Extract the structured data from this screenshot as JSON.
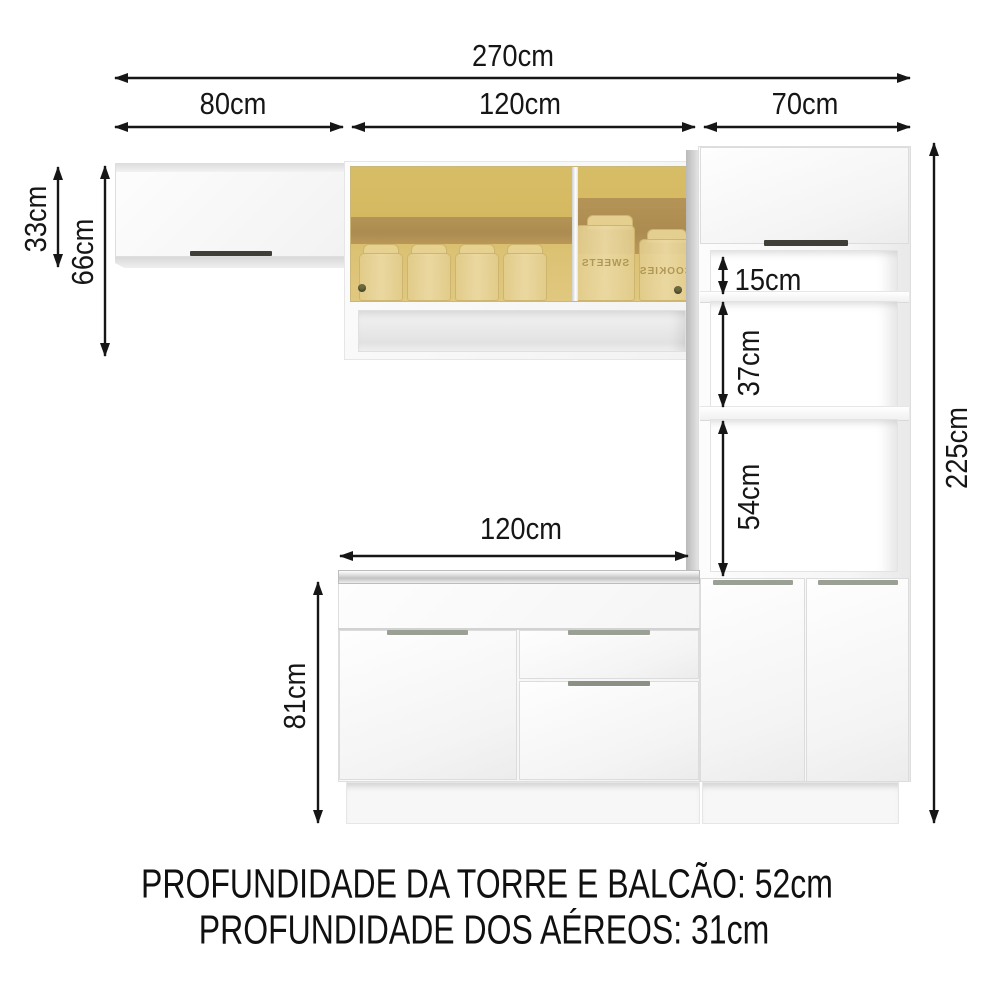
{
  "diagram": {
    "dimensions": {
      "total_width": "270cm",
      "aereo_left_width": "80cm",
      "aereo_glass_width": "120cm",
      "tower_width": "70cm",
      "aereo_left_height": "33cm",
      "aereo_glass_height": "66cm",
      "total_height": "225cm",
      "tower_niche_top": "15cm",
      "tower_niche_middle": "37cm",
      "tower_niche_bottom": "54cm",
      "counter_width": "120cm",
      "counter_height": "81cm"
    },
    "footer": {
      "line1": "PROFUNDIDADE DA TORRE E BALCÃO: 52cm",
      "line2": "PROFUNDIDADE DOS AÉREOS: 31cm"
    },
    "jar_labels": {
      "left_jar": "SWEETS",
      "right_jar": "COOKIES"
    },
    "colors": {
      "dimension_line": "#161616",
      "cabinet_white": "#fbfbfb",
      "glass_amber": "#d8c06a",
      "interior_brown": "#8f6c48",
      "jar_cream": "#f2e6c0"
    }
  }
}
